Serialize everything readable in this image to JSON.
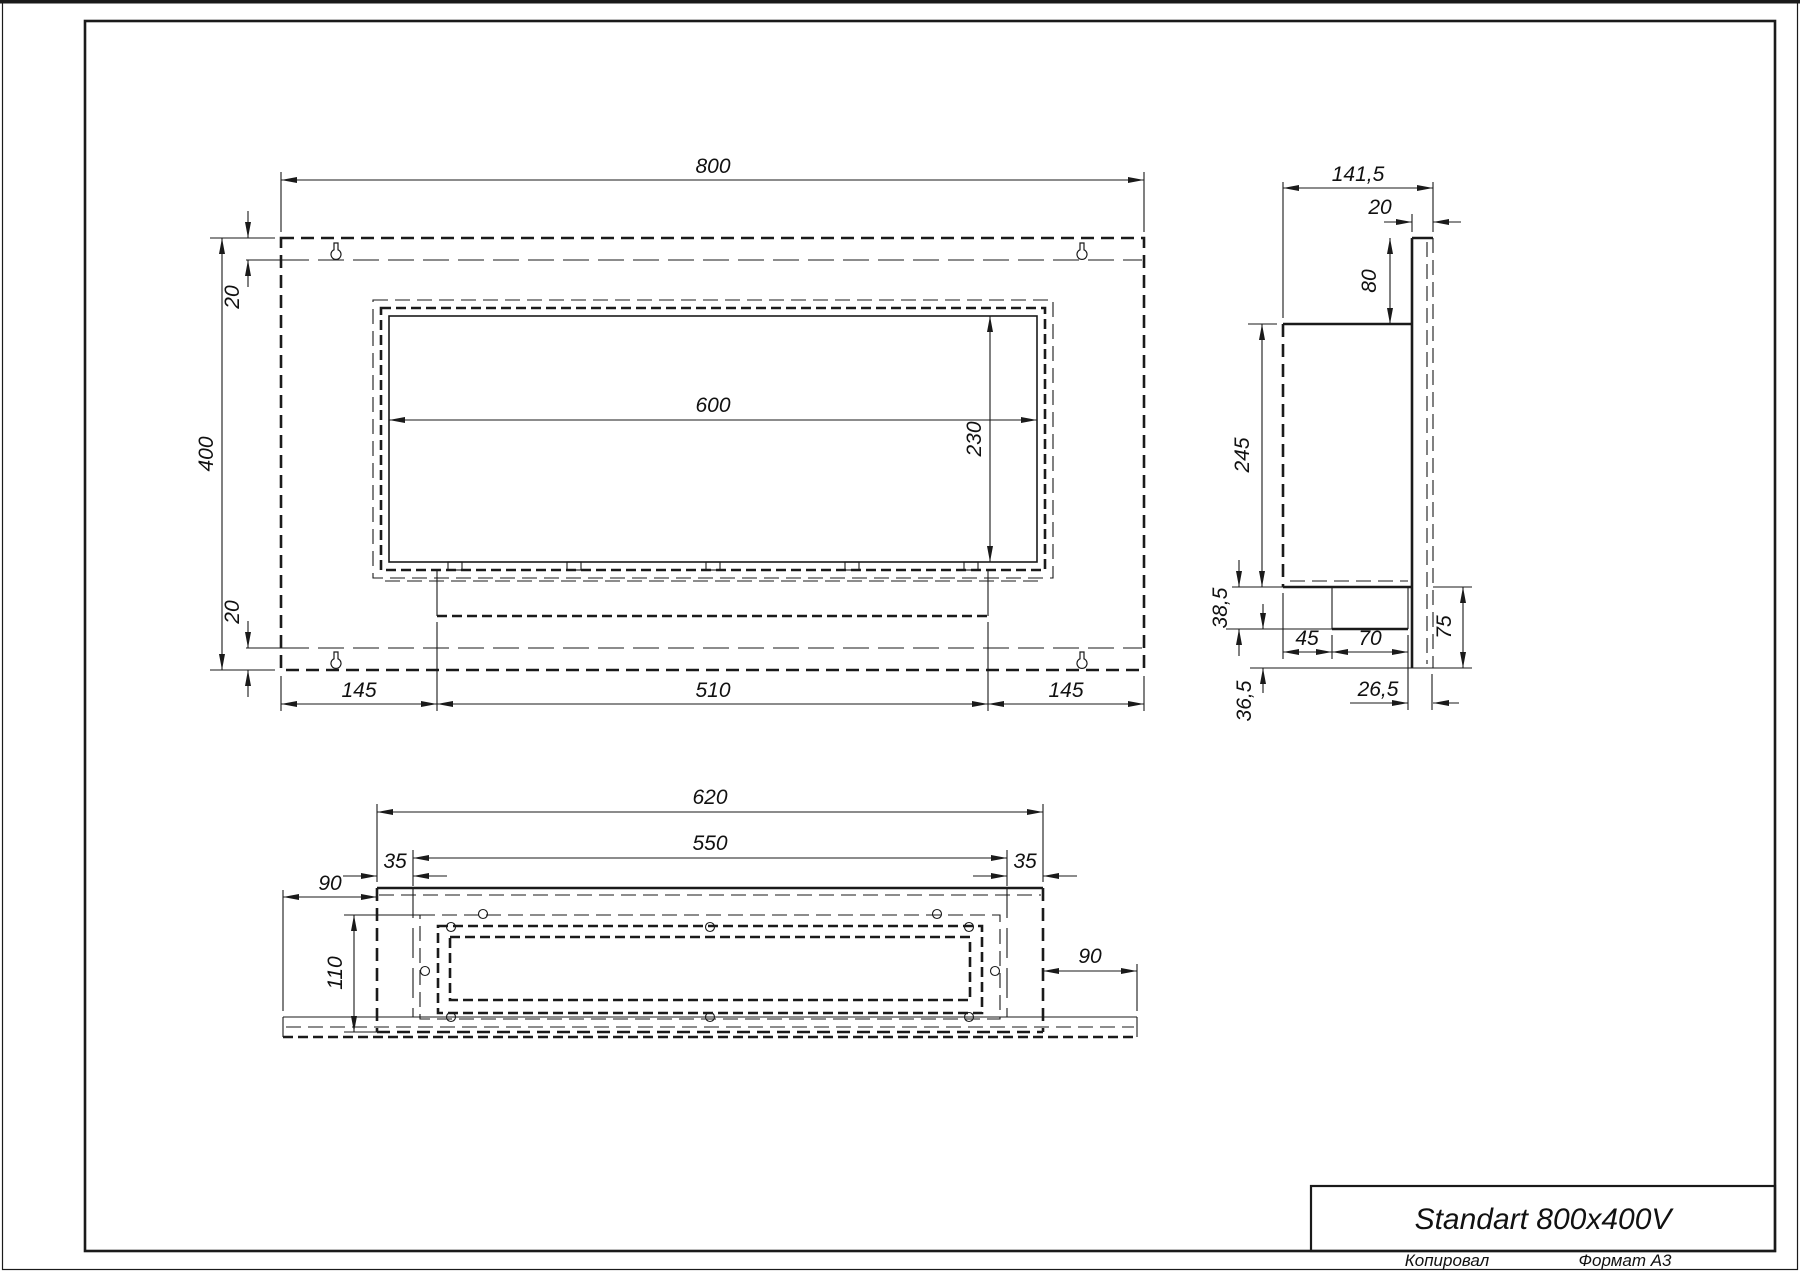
{
  "page": {
    "background": "#ffffff",
    "ink_color": "#1a1a1a",
    "copied_label": "Копировал",
    "format_label": "Формат А3"
  },
  "title_block": {
    "part_name": "Standart 800x400V"
  },
  "front_view": {
    "overall_width": "800",
    "overall_height": "400",
    "flange_top": "20",
    "flange_bottom": "20",
    "opening_width": "600",
    "opening_height": "230",
    "bottom_left_margin": "145",
    "burner_width": "510",
    "bottom_right_margin": "145"
  },
  "side_view": {
    "overall_depth": "141,5",
    "back_panel_thickness": "20",
    "back_panel_top_height": "80",
    "body_height": "245",
    "tray_height": "38,5",
    "lower_back_height": "36,5",
    "tray_front_offset": "45",
    "tray_depth": "70",
    "tray_back_gap": "26,5",
    "back_bottom_height": "75"
  },
  "bottom_view": {
    "body_width": "620",
    "fold_span": "550",
    "left_inset": "35",
    "right_inset": "35",
    "left_flange": "90",
    "opening_depth": "110",
    "right_flange": "90"
  }
}
